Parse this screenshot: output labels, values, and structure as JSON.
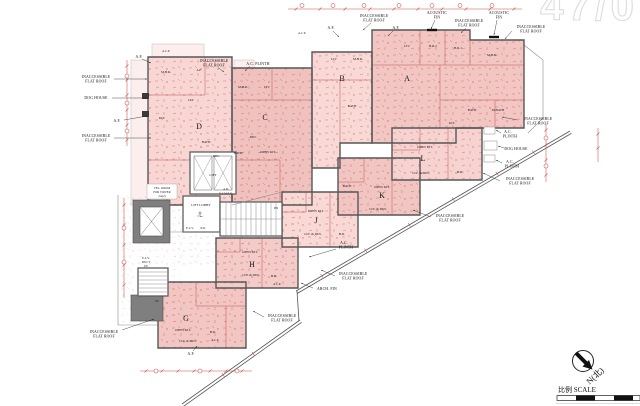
{
  "watermark": "47/0",
  "ann": {
    "inaccessible": "INACCESSIBLE",
    "flat_roof": "FLAT ROOF",
    "dog_house": "DOG HOUSE",
    "ac": "A.C.",
    "plinth": "PLINTH",
    "ac_plinth": "A.C. PLINTH",
    "af": "A.F.",
    "acp": "A.C.P.",
    "acoustic": "ACOUSTIC",
    "fin": "FIN",
    "arch_fin": "ARCH. FIN"
  },
  "units": {
    "a": {
      "letter": "A",
      "liv": "LIV",
      "br2": "B.R.2",
      "br1": "B.R.1",
      "mbr": "M.B.R.",
      "kit": "KIT.",
      "bath": "BATH",
      "mbath": "M.BATH"
    },
    "b": {
      "letter": "B",
      "liv": "LIV",
      "mbr": "M.B.R.",
      "bath": "BATH"
    },
    "c": {
      "letter": "C",
      "mbr": "M.B.R.",
      "liv": "LIV",
      "din": "DIN.",
      "bath": "BATH",
      "openkit": "OPEN KIT."
    },
    "d": {
      "letter": "D",
      "mbr": "M.B.R.",
      "liv": "LIV",
      "kit": "KIT.",
      "din": "DIN.",
      "bath": "BATH"
    },
    "g": {
      "letter": "G",
      "openkit": "OPEN KIT.",
      "livdin": "LIV. & DIN.",
      "br": "B.R.",
      "acp": "A.C.P."
    },
    "h": {
      "letter": "H",
      "openkit": "OPEN KIT.",
      "livdin": "LIV. & DIN.",
      "br": "B.R.",
      "acp": "A.C.P."
    },
    "j": {
      "letter": "J",
      "openkit": "OPEN KIT.",
      "livdin": "LIV. & DIN.",
      "br": "B.R."
    },
    "k": {
      "letter": "K",
      "openkit": "OPEN KIT.",
      "livdin": "LIV. & DIN.",
      "bath": "BATH"
    },
    "l": {
      "letter": "L",
      "openkit": "OPEN KIT.",
      "livdin": "LIV. & DIN.",
      "br": "B.R."
    }
  },
  "core": {
    "lift": "LIFT",
    "lift_lobby": "LIFT LOBBY",
    "tel1": "TEL. ROOM",
    "tel2": "FOR TOWER",
    "tel3": "2A(2)",
    "ad": "A.D.",
    "rsmrr": "R.S.M.R.R.",
    "elv": "E.L.V.",
    "pd": "P.D.",
    "duct": "DUCT",
    "up": "UP",
    "dn": "DN"
  },
  "compass": {
    "label": "N(北)"
  },
  "scalebar": {
    "label": "比例 SCALE"
  }
}
